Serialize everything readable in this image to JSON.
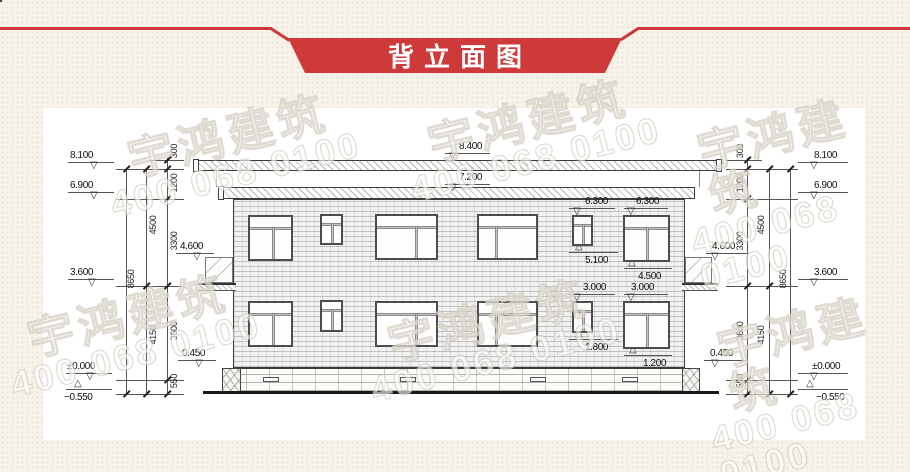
{
  "header": {
    "title": "背立面图",
    "accent": "#ce3a3a",
    "text_color": "#ffffff"
  },
  "watermark": {
    "line1": "宇鸿建筑",
    "line2": "400 068 0100",
    "tiles": [
      {
        "x": 130,
        "y": 110
      },
      {
        "x": 430,
        "y": 95
      },
      {
        "x": 710,
        "y": 105
      },
      {
        "x": 30,
        "y": 290
      },
      {
        "x": 390,
        "y": 295
      },
      {
        "x": 730,
        "y": 305
      }
    ]
  },
  "drawing": {
    "flags": [
      {
        "t": "8.100",
        "lx": 68,
        "ly": 162,
        "lw": 46,
        "tx": 90,
        "dir": "down",
        "bx": 70,
        "by": 150
      },
      {
        "t": "6.900",
        "lx": 68,
        "ly": 192,
        "lw": 46,
        "tx": 90,
        "dir": "down",
        "bx": 70,
        "by": 180
      },
      {
        "t": "3.600",
        "lx": 68,
        "ly": 279,
        "lw": 46,
        "tx": 88,
        "dir": "down",
        "bx": 70,
        "by": 267
      },
      {
        "t": "±0.000",
        "lx": 66,
        "ly": 373,
        "lw": 46,
        "tx": 86,
        "dir": "down",
        "bx": 67,
        "by": 361
      },
      {
        "t": "−0.550",
        "lx": 66,
        "ly": 389,
        "lw": 46,
        "tx": 74,
        "dir": "up",
        "bx": 64,
        "by": 392
      },
      {
        "t": "8.100",
        "lx": 798,
        "ly": 162,
        "lw": 50,
        "tx": 810,
        "dir": "down",
        "bx": 814,
        "by": 150
      },
      {
        "t": "6.900",
        "lx": 798,
        "ly": 192,
        "lw": 50,
        "tx": 810,
        "dir": "down",
        "bx": 814,
        "by": 180
      },
      {
        "t": "3.600",
        "lx": 798,
        "ly": 279,
        "lw": 50,
        "tx": 810,
        "dir": "down",
        "bx": 814,
        "by": 267
      },
      {
        "t": "±0.000",
        "lx": 798,
        "ly": 373,
        "lw": 50,
        "tx": 810,
        "dir": "down",
        "bx": 812,
        "by": 361
      },
      {
        "t": "−0.550",
        "lx": 798,
        "ly": 389,
        "lw": 50,
        "tx": 806,
        "dir": "up",
        "bx": 816,
        "by": 392
      },
      {
        "t": "8.400",
        "lx": 445,
        "ly": 153,
        "lw": 45,
        "tx": 449,
        "dir": "down",
        "bx": 459,
        "by": 141
      },
      {
        "t": "7.200",
        "lx": 445,
        "ly": 184,
        "lw": 45,
        "tx": 449,
        "dir": "down",
        "bx": 459,
        "by": 172
      },
      {
        "t": "6.300",
        "lx": 569,
        "ly": 208,
        "lw": 46,
        "tx": 573,
        "dir": "down",
        "bx": 585,
        "by": 196
      },
      {
        "t": "6.300",
        "lx": 624,
        "ly": 208,
        "lw": 44,
        "tx": 627,
        "dir": "down",
        "bx": 636,
        "by": 196
      },
      {
        "t": "5.100",
        "lx": 569,
        "ly": 252,
        "lw": 49,
        "tx": 575,
        "dir": "up",
        "bx": 585,
        "by": 255
      },
      {
        "t": "4.500",
        "lx": 624,
        "ly": 268,
        "lw": 48,
        "tx": 628,
        "dir": "up",
        "bx": 638,
        "by": 271
      },
      {
        "t": "3.000",
        "lx": 569,
        "ly": 294,
        "lw": 46,
        "tx": 573,
        "dir": "down",
        "bx": 583,
        "by": 282
      },
      {
        "t": "3.000",
        "lx": 624,
        "ly": 294,
        "lw": 44,
        "tx": 627,
        "dir": "down",
        "bx": 631,
        "by": 282
      },
      {
        "t": "1.800",
        "lx": 569,
        "ly": 339,
        "lw": 49,
        "tx": 575,
        "dir": "up",
        "bx": 585,
        "by": 342
      },
      {
        "t": "1.200",
        "lx": 624,
        "ly": 355,
        "lw": 48,
        "tx": 629,
        "dir": "up",
        "bx": 643,
        "by": 358
      },
      {
        "t": "4.600",
        "lx": 176,
        "ly": 253,
        "lw": 38,
        "tx": 193,
        "dir": "down",
        "bx": 180,
        "by": 241
      },
      {
        "t": "4.600",
        "lx": 706,
        "ly": 253,
        "lw": 42,
        "tx": 711,
        "dir": "down",
        "bx": 712,
        "by": 241
      },
      {
        "t": "0.450",
        "lx": 178,
        "ly": 360,
        "lw": 38,
        "tx": 195,
        "dir": "down",
        "bx": 182,
        "by": 348
      },
      {
        "t": "0.450",
        "lx": 704,
        "ly": 360,
        "lw": 42,
        "tx": 711,
        "dir": "down",
        "bx": 710,
        "by": 348
      }
    ],
    "chain_lines": [
      {
        "x": 126,
        "y1": 169,
        "y2": 394
      },
      {
        "x": 146,
        "y1": 169,
        "y2": 394
      },
      {
        "x": 167,
        "y1": 158,
        "y2": 394
      },
      {
        "x": 747,
        "y1": 158,
        "y2": 394
      },
      {
        "x": 769,
        "y1": 169,
        "y2": 394
      },
      {
        "x": 790,
        "y1": 169,
        "y2": 394
      }
    ],
    "ext_lines": [
      {
        "x": 150,
        "y": 160,
        "w": 34
      },
      {
        "x": 116,
        "y": 169,
        "w": 68
      },
      {
        "x": 116,
        "y": 199,
        "w": 68
      },
      {
        "x": 116,
        "y": 286,
        "w": 68
      },
      {
        "x": 116,
        "y": 380,
        "w": 68
      },
      {
        "x": 116,
        "y": 394,
        "w": 68
      },
      {
        "x": 726,
        "y": 160,
        "w": 36
      },
      {
        "x": 726,
        "y": 169,
        "w": 72
      },
      {
        "x": 726,
        "y": 199,
        "w": 72
      },
      {
        "x": 726,
        "y": 286,
        "w": 72
      },
      {
        "x": 726,
        "y": 380,
        "w": 72
      },
      {
        "x": 726,
        "y": 394,
        "w": 72
      }
    ],
    "ticks": [
      {
        "x": 167,
        "y": 160
      },
      {
        "x": 167,
        "y": 169
      },
      {
        "x": 167,
        "y": 199
      },
      {
        "x": 167,
        "y": 286
      },
      {
        "x": 167,
        "y": 380
      },
      {
        "x": 167,
        "y": 394
      },
      {
        "x": 146,
        "y": 169
      },
      {
        "x": 146,
        "y": 286
      },
      {
        "x": 146,
        "y": 394
      },
      {
        "x": 126,
        "y": 169
      },
      {
        "x": 126,
        "y": 394
      },
      {
        "x": 747,
        "y": 160
      },
      {
        "x": 747,
        "y": 169
      },
      {
        "x": 747,
        "y": 199
      },
      {
        "x": 747,
        "y": 286
      },
      {
        "x": 747,
        "y": 380
      },
      {
        "x": 747,
        "y": 394
      },
      {
        "x": 769,
        "y": 169
      },
      {
        "x": 769,
        "y": 286
      },
      {
        "x": 769,
        "y": 394
      },
      {
        "x": 790,
        "y": 169
      },
      {
        "x": 790,
        "y": 394
      }
    ],
    "dim_labels": [
      {
        "t": "300",
        "x": 174,
        "y": 152
      },
      {
        "t": "1200",
        "x": 174,
        "y": 184
      },
      {
        "t": "3300",
        "x": 174,
        "y": 242
      },
      {
        "t": "3600",
        "x": 174,
        "y": 332
      },
      {
        "t": "550",
        "x": 174,
        "y": 382
      },
      {
        "t": "4500",
        "x": 153,
        "y": 226
      },
      {
        "t": "4150",
        "x": 153,
        "y": 336
      },
      {
        "t": "8650",
        "x": 131,
        "y": 280
      },
      {
        "t": "300",
        "x": 740,
        "y": 152
      },
      {
        "t": "1200",
        "x": 740,
        "y": 184
      },
      {
        "t": "3300",
        "x": 740,
        "y": 242
      },
      {
        "t": "3600",
        "x": 740,
        "y": 332
      },
      {
        "t": "550",
        "x": 740,
        "y": 382
      },
      {
        "t": "4500",
        "x": 761,
        "y": 226
      },
      {
        "t": "4150",
        "x": 761,
        "y": 336
      },
      {
        "t": "8650",
        "x": 783,
        "y": 280
      }
    ],
    "windows": [
      {
        "x": 248,
        "y": 215,
        "w": 45,
        "h": 46,
        "t": 0.26,
        "v": 0.55
      },
      {
        "x": 320,
        "y": 214,
        "w": 23,
        "h": 31,
        "t": 0.3,
        "v": 0.5
      },
      {
        "x": 375,
        "y": 214,
        "w": 63,
        "h": 46,
        "t": 0.26,
        "v": 0.66
      },
      {
        "x": 477,
        "y": 214,
        "w": 61,
        "h": 46,
        "t": 0.26,
        "v": 0.3
      },
      {
        "x": 572,
        "y": 215,
        "w": 21,
        "h": 31,
        "t": 0.3,
        "v": 0.5
      },
      {
        "x": 623,
        "y": 215,
        "w": 47,
        "h": 47,
        "t": 0.26,
        "v": 0.5
      },
      {
        "x": 248,
        "y": 301,
        "w": 45,
        "h": 46,
        "t": 0.26,
        "v": 0.55
      },
      {
        "x": 320,
        "y": 300,
        "w": 23,
        "h": 32,
        "t": 0.3,
        "v": 0.5
      },
      {
        "x": 375,
        "y": 301,
        "w": 63,
        "h": 46,
        "t": 0.26,
        "v": 0.66
      },
      {
        "x": 477,
        "y": 301,
        "w": 61,
        "h": 46,
        "t": 0.26,
        "v": 0.3
      },
      {
        "x": 572,
        "y": 301,
        "w": 21,
        "h": 32,
        "t": 0.3,
        "v": 0.5
      },
      {
        "x": 623,
        "y": 301,
        "w": 47,
        "h": 48,
        "t": 0.26,
        "v": 0.5
      }
    ],
    "vents": [
      {
        "x": 263
      },
      {
        "x": 400
      },
      {
        "x": 530
      },
      {
        "x": 622
      }
    ]
  }
}
